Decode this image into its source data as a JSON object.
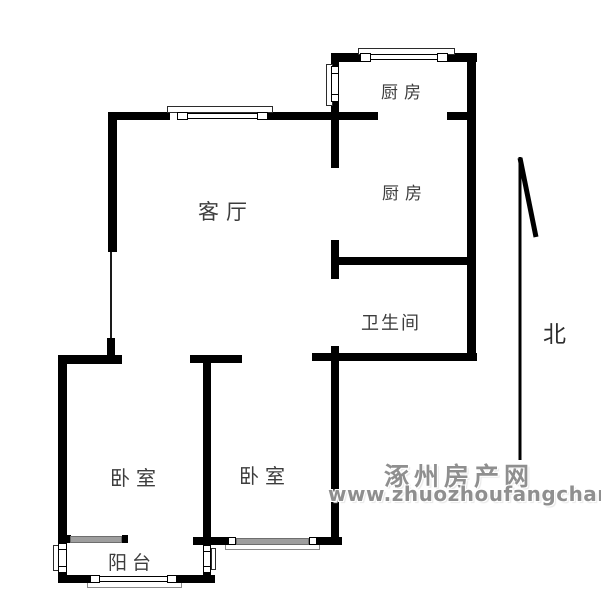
{
  "floorplan": {
    "rooms": {
      "kitchen_top": {
        "label": "厨房"
      },
      "kitchen_mid": {
        "label": "厨房"
      },
      "living": {
        "label": "客厅"
      },
      "bathroom": {
        "label": "卫生间"
      },
      "bedroom_left": {
        "label": "卧室"
      },
      "bedroom_right": {
        "label": "卧室"
      },
      "balcony": {
        "label": "阳台"
      }
    },
    "compass": {
      "north_label": "北"
    },
    "watermark": {
      "site_name": "涿州房产网",
      "site_url": "www.zhuozhoufangchan.com"
    },
    "colors": {
      "wall": "#000000",
      "window_gray": "#9e9e9e",
      "watermark_gray": "#8f8f8f",
      "label_text": "#3d3d3d"
    }
  }
}
